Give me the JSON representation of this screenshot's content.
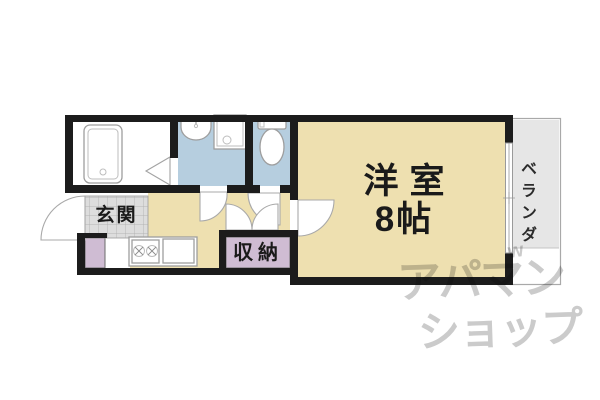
{
  "colors": {
    "wall": "#1c1c1c",
    "room_cream": "#eee0b0",
    "wet_blue": "#b6cedf",
    "storage_lavender": "#cfbcd3",
    "tile_gray": "#dddddd",
    "veranda_gray": "#e6e6e6",
    "fixture_stroke": "#9e9e9e",
    "watermark_gray": "#cbcbcb",
    "label_ink": "#1a1a1a"
  },
  "rooms": {
    "entrance": {
      "label": "玄関"
    },
    "storage": {
      "label": "収納"
    },
    "western_room": {
      "name": "洋室",
      "size": "8帖"
    },
    "veranda": {
      "label": "ベランダ"
    }
  },
  "fixtures": [
    "bathtub",
    "folding-bath-door",
    "washbasin",
    "washing-machine-pan",
    "toilet",
    "gas-stove",
    "kitchen-sink",
    "kitchen-counter"
  ],
  "watermark": {
    "line1": "アパマン",
    "mark": "w",
    "line2": "ショップ"
  }
}
